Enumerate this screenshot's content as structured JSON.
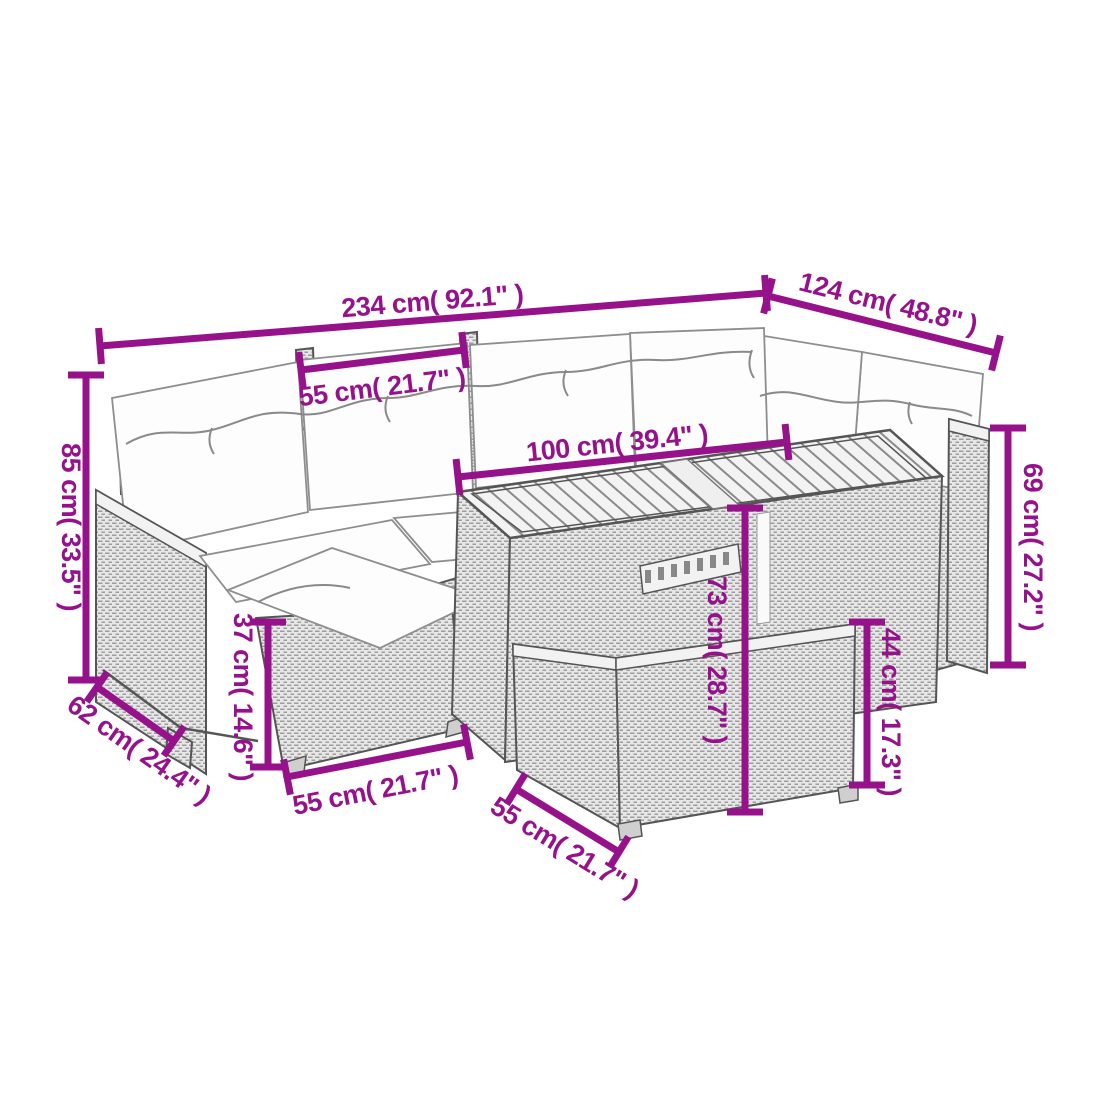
{
  "diagram": {
    "title": "Garden lounge set dimension line drawing",
    "style": {
      "dimension_color": "#96128b",
      "line_art_color": "#555555",
      "background": "#ffffff"
    },
    "units": {
      "primary": "cm",
      "secondary": "inch"
    }
  },
  "dims": [
    {
      "name": "sofa-long-side-width",
      "label": "234 cm( 92.1\" )"
    },
    {
      "name": "sofa-short-side-width",
      "label": "124 cm( 48.8\" )"
    },
    {
      "name": "seat-module-width",
      "label": "55 cm( 21.7\" )"
    },
    {
      "name": "table-top-length",
      "label": "100 cm( 39.4\" )"
    },
    {
      "name": "backrest-height",
      "label": "85 cm( 33.5\" )"
    },
    {
      "name": "armrest-height",
      "label": "69 cm( 27.2\" )"
    },
    {
      "name": "seat-depth",
      "label": "62 cm( 24.4\" )"
    },
    {
      "name": "footstool-height",
      "label": "37 cm( 14.6\" )"
    },
    {
      "name": "table-height",
      "label": "73 cm( 28.7\" )"
    },
    {
      "name": "bench-height",
      "label": "44 cm( 17.3\" )"
    },
    {
      "name": "footstool-width",
      "label": "55 cm( 21.7\" )"
    },
    {
      "name": "bench-width",
      "label": "55 cm( 21.7\" )"
    }
  ]
}
